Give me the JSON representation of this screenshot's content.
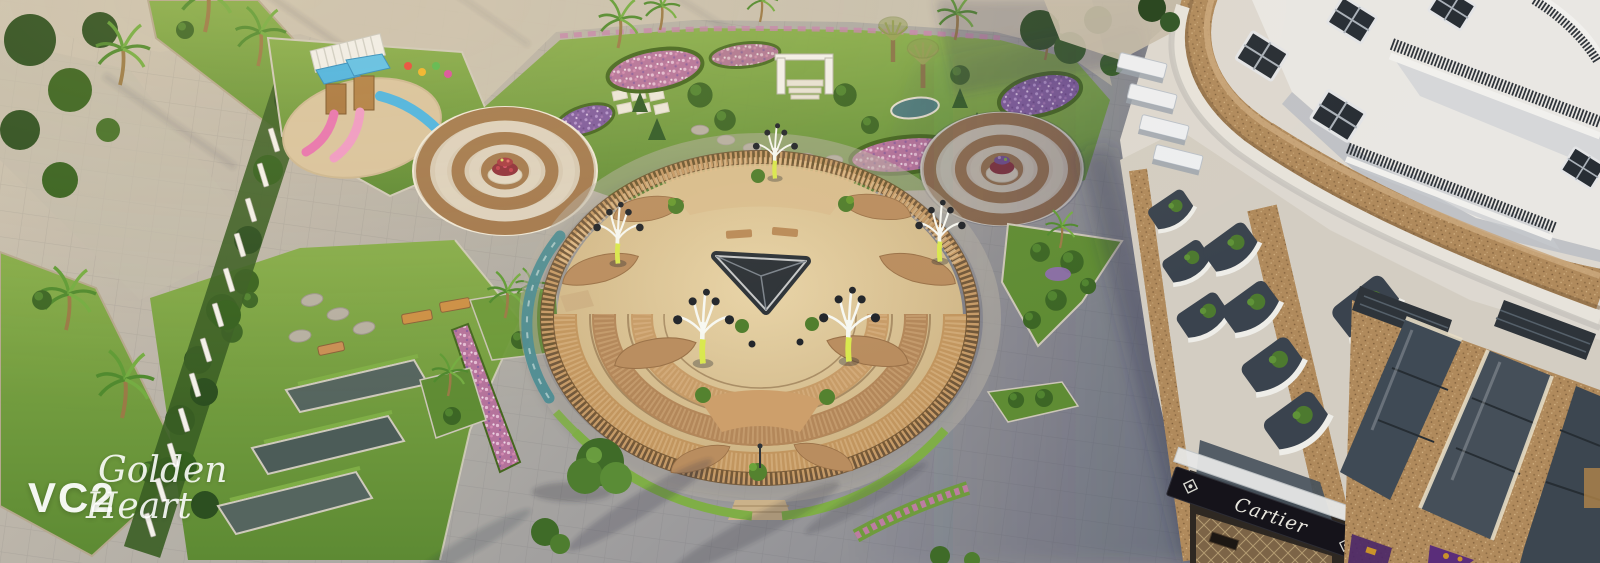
{
  "watermark": {
    "project_code": "VC2",
    "script_line1": "Golden",
    "script_line2": "Heart"
  },
  "storefront": {
    "sign_label": "Cartier"
  },
  "palette": {
    "paver_light": "#c3bbae",
    "paver_shadow": "#83858e",
    "walkway": "#cbc2b0",
    "grass": "#76a03c",
    "grass_dark": "#5d8a33",
    "hedge": "#3f6b28",
    "flower_pink": "#c585ab",
    "flower_purple": "#8f6bb0",
    "ring_brown": "#a3794e",
    "ring_cream": "#ddd2bf",
    "sand": "#dcc69c",
    "wood": "#b98d5f",
    "wood_dark": "#8a6138",
    "water": "#4d8d94",
    "skylight": "#2b3137",
    "sculpture_glow": "#d9e84e",
    "granite": "#b08a5c",
    "facade_white": "#e9e7e3",
    "window_dark": "#272d34",
    "railing_dark": "#2f343a",
    "fascia_black": "#15131a",
    "sign_white": "#e9e7df",
    "shop_purple": "#5a2d7a",
    "shop_gold": "#c9932a",
    "play_blue": "#49b4e4",
    "play_pink": "#e873b0",
    "play_sand": "#d9c49f"
  }
}
